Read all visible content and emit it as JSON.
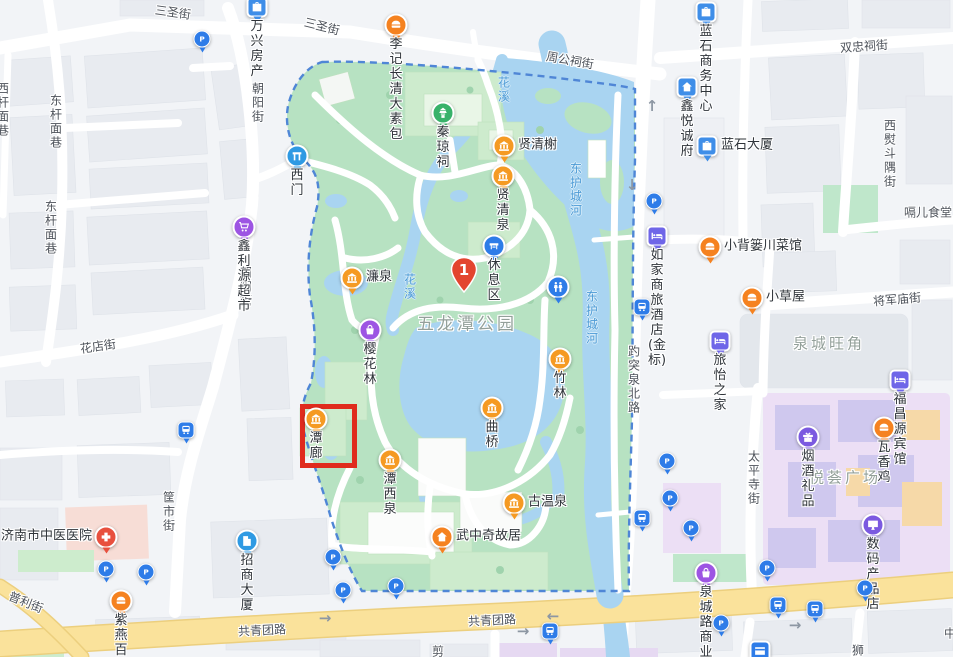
{
  "map": {
    "colors": {
      "park_green": "#b7e2c2",
      "park_building": "#cdebcd",
      "water": "#a9d4f1",
      "road_yellow": "#fae29b",
      "boundary_blue": "#4f86d6",
      "highlight_red": "#e02b1d",
      "marker_red": "#e3452f",
      "poi_orange": "#f59a23",
      "poi_food_orange": "#f58220",
      "poi_blue": "#2e7ce8",
      "poi_purple": "#9d55e3",
      "poi_hotel": "#6f66e8",
      "commercial_purple": "#ecdff5",
      "hospital_pink": "#f7ddd6"
    },
    "marker": {
      "number": "1",
      "x": 464,
      "y": 292
    },
    "highlight": {
      "x": 300,
      "y": 404,
      "w": 47,
      "h": 54
    },
    "area_labels": [
      {
        "text": "五龙潭公园",
        "x": 467,
        "y": 322,
        "size": 17
      },
      {
        "text": "泉城旺角",
        "x": 829,
        "y": 343,
        "size": 15
      },
      {
        "text": "悦荟广场",
        "x": 845,
        "y": 477,
        "size": 15
      }
    ],
    "street_labels": [
      {
        "text": "三圣街",
        "x": 173,
        "y": 12,
        "rot": 8
      },
      {
        "text": "三圣街",
        "x": 322,
        "y": 26,
        "rot": 14
      },
      {
        "text": "周公祠街",
        "x": 570,
        "y": 60,
        "rot": 10
      },
      {
        "text": "双忠祠街",
        "x": 864,
        "y": 46,
        "rot": -4
      },
      {
        "text": "西熨斗隅街",
        "x": 890,
        "y": 154,
        "vertical": true
      },
      {
        "text": "朝阳街",
        "x": 258,
        "y": 103,
        "vertical": true
      },
      {
        "text": "朝阳街",
        "x": 246,
        "y": 287,
        "vertical": true
      },
      {
        "text": "东杆面巷",
        "x": 56,
        "y": 122,
        "vertical": true
      },
      {
        "text": "东杆面巷",
        "x": 51,
        "y": 228,
        "vertical": true
      },
      {
        "text": "西杆面巷",
        "x": 3,
        "y": 110,
        "vertical": true
      },
      {
        "text": "花店街",
        "x": 98,
        "y": 346,
        "rot": -8
      },
      {
        "text": "筐市街",
        "x": 169,
        "y": 512,
        "vertical": true
      },
      {
        "text": "普利街",
        "x": 26,
        "y": 602,
        "rot": 22
      },
      {
        "text": "共青团路",
        "x": 262,
        "y": 630,
        "rot": -3
      },
      {
        "text": "共青团路",
        "x": 492,
        "y": 620,
        "rot": -3
      },
      {
        "text": "将军庙街",
        "x": 897,
        "y": 299,
        "rot": -5
      },
      {
        "text": "太平寺街",
        "x": 754,
        "y": 478,
        "vertical": true
      },
      {
        "text": "趵突泉北路",
        "x": 634,
        "y": 380,
        "vertical": true
      },
      {
        "text": "嗝儿食堂",
        "x": 928,
        "y": 212
      },
      {
        "text": "剪",
        "x": 438,
        "y": 651
      },
      {
        "text": "狮",
        "x": 858,
        "y": 650
      },
      {
        "text": "中",
        "x": 950,
        "y": 633
      }
    ],
    "water_labels": [
      {
        "text": "花溪",
        "x": 504,
        "y": 90,
        "vertical": true
      },
      {
        "text": "花溪",
        "x": 410,
        "y": 287,
        "vertical": true
      },
      {
        "text": "东护城河",
        "x": 576,
        "y": 190,
        "vertical": true
      },
      {
        "text": "东护城河",
        "x": 592,
        "y": 318,
        "vertical": true
      }
    ],
    "pois": [
      {
        "id": "wanxing-fangchan",
        "label": "万兴房产",
        "icon": "briefcase",
        "shape": "square",
        "color": "#3f8ee8",
        "x": 257,
        "y": 7,
        "label_pos": "below"
      },
      {
        "id": "liji-changqing-dasubao",
        "label": "李记长清大素包",
        "icon": "food",
        "shape": "circle",
        "color": "#f58220",
        "x": 396,
        "y": 25,
        "label_pos": "below"
      },
      {
        "id": "lanshi-business-center",
        "label": "蓝石商务中心",
        "icon": "briefcase",
        "shape": "square",
        "color": "#3f8ee8",
        "x": 706,
        "y": 12,
        "label_pos": "below"
      },
      {
        "id": "xinyue-chengfu",
        "label": "鑫悦诚府",
        "icon": "house",
        "shape": "square",
        "color": "#3f8ee8",
        "x": 687,
        "y": 87,
        "label_pos": "below"
      },
      {
        "id": "lanshi-daxia",
        "label": "蓝石大厦",
        "icon": "briefcase",
        "shape": "square",
        "color": "#3f8ee8",
        "x": 707,
        "y": 146,
        "label_pos": "right"
      },
      {
        "id": "ximen-west-gate",
        "label": "西门",
        "icon": "gate",
        "shape": "pinshape",
        "color": "#2f9ae3",
        "x": 297,
        "y": 156,
        "label_pos": "below"
      },
      {
        "id": "xinliyuan-chaoshi",
        "label": "鑫利源超市",
        "icon": "cart",
        "shape": "circle",
        "color": "#9d55e3",
        "x": 244,
        "y": 227,
        "label_pos": "below"
      },
      {
        "id": "qinqiong-ci",
        "label": "秦琼祠",
        "icon": "temple",
        "shape": "circle",
        "color": "#38b26a",
        "x": 443,
        "y": 113,
        "label_pos": "below"
      },
      {
        "id": "xianqing-xie",
        "label": "贤清榭",
        "icon": "museum",
        "shape": "circle",
        "color": "#f59a23",
        "x": 504,
        "y": 146,
        "label_pos": "right"
      },
      {
        "id": "xianqing-quan",
        "label": "贤清泉",
        "icon": "museum",
        "shape": "circle",
        "color": "#f59a23",
        "x": 503,
        "y": 176,
        "label_pos": "below"
      },
      {
        "id": "xiuxi-qu-rest-area",
        "label": "休息区",
        "icon": "bench",
        "shape": "circle",
        "color": "#2e7ce8",
        "x": 494,
        "y": 246,
        "label_pos": "below"
      },
      {
        "id": "restroom",
        "label": "",
        "icon": "wc",
        "shape": "circle",
        "color": "#2e7ce8",
        "x": 558,
        "y": 287,
        "label_pos": "none"
      },
      {
        "id": "lian-quan",
        "label": "濂泉",
        "icon": "museum",
        "shape": "circle",
        "color": "#f59a23",
        "x": 352,
        "y": 278,
        "label_pos": "right"
      },
      {
        "id": "yinghua-lin",
        "label": "樱花林",
        "icon": "bag",
        "shape": "circle",
        "color": "#9d55e3",
        "x": 370,
        "y": 330,
        "label_pos": "below"
      },
      {
        "id": "zhu-lin",
        "label": "竹林",
        "icon": "museum",
        "shape": "circle",
        "color": "#f59a23",
        "x": 560,
        "y": 359,
        "label_pos": "below"
      },
      {
        "id": "qu-qiao",
        "label": "曲桥",
        "icon": "museum",
        "shape": "circle",
        "color": "#f59a23",
        "x": 492,
        "y": 408,
        "label_pos": "below"
      },
      {
        "id": "tan-lang",
        "label": "潭廊",
        "icon": "museum",
        "shape": "circle",
        "color": "#f59a23",
        "x": 316,
        "y": 419,
        "label_pos": "below"
      },
      {
        "id": "tanxi-quan",
        "label": "潭西泉",
        "icon": "museum",
        "shape": "circle",
        "color": "#f59a23",
        "x": 390,
        "y": 460,
        "label_pos": "below"
      },
      {
        "id": "gu-wenquan",
        "label": "古温泉",
        "icon": "museum",
        "shape": "circle",
        "color": "#f59a23",
        "x": 514,
        "y": 503,
        "label_pos": "right"
      },
      {
        "id": "wuzhongqi-guju",
        "label": "武中奇故居",
        "icon": "house",
        "shape": "circle",
        "color": "#f58220",
        "x": 442,
        "y": 537,
        "label_pos": "right"
      },
      {
        "id": "rujia-hotel",
        "label": "如家商旅\n酒店(金标)",
        "icon": "bed",
        "shape": "square",
        "color": "#6f66e8",
        "x": 657,
        "y": 236,
        "label_pos": "below"
      },
      {
        "id": "xiaobeilou-chuancaiguan",
        "label": "小背篓川菜馆",
        "icon": "food",
        "shape": "circle",
        "color": "#f58220",
        "x": 710,
        "y": 247,
        "label_pos": "right"
      },
      {
        "id": "xiaocaowu",
        "label": "小草屋",
        "icon": "food",
        "shape": "circle",
        "color": "#f58220",
        "x": 752,
        "y": 298,
        "label_pos": "right"
      },
      {
        "id": "lvyi-zhijia",
        "label": "旅怡之家",
        "icon": "bed",
        "shape": "square",
        "color": "#6f66e8",
        "x": 720,
        "y": 341,
        "label_pos": "below"
      },
      {
        "id": "fuchangyuan-binguan",
        "label": "福昌源宾馆",
        "icon": "bed",
        "shape": "square",
        "color": "#6f66e8",
        "x": 900,
        "y": 380,
        "label_pos": "below"
      },
      {
        "id": "yanjiu-lipin",
        "label": "烟酒礼品",
        "icon": "gift",
        "shape": "circle",
        "color": "#7b5ae0",
        "x": 808,
        "y": 437,
        "label_pos": "below"
      },
      {
        "id": "waxiang-ji",
        "label": "瓦香鸡",
        "icon": "food",
        "shape": "circle",
        "color": "#f58220",
        "x": 884,
        "y": 428,
        "label_pos": "below"
      },
      {
        "id": "shuma-chanpin-dian",
        "label": "数码产品店",
        "icon": "monitor",
        "shape": "circle",
        "color": "#7b5ae0",
        "x": 873,
        "y": 525,
        "label_pos": "below"
      },
      {
        "id": "quanchenglu-shangyejie",
        "label": "泉城路商业街",
        "icon": "bag",
        "shape": "circle",
        "color": "#9d55e3",
        "x": 706,
        "y": 573,
        "label_pos": "below"
      },
      {
        "id": "jinan-zhongyi-hospital",
        "label": "济南市中医医院",
        "icon": "cross",
        "shape": "circle",
        "color": "#e8503e",
        "x": 106,
        "y": 537,
        "label_pos": "left"
      },
      {
        "id": "zhaoshang-daxia",
        "label": "招商大厦",
        "icon": "building",
        "shape": "circle",
        "color": "#2f9ae3",
        "x": 247,
        "y": 541,
        "label_pos": "below"
      },
      {
        "id": "ziyan-baiweiji",
        "label": "紫燕百味鸡",
        "icon": "food",
        "shape": "circle",
        "color": "#f58220",
        "x": 121,
        "y": 601,
        "label_pos": "below"
      },
      {
        "id": "bank-card-service",
        "label": "",
        "icon": "card",
        "shape": "square",
        "color": "#2e7ce8",
        "x": 760,
        "y": 651,
        "label_pos": "none"
      }
    ],
    "parking_icons": [
      [
        202,
        39
      ],
      [
        654,
        201
      ],
      [
        106,
        569
      ],
      [
        146,
        572
      ],
      [
        333,
        557
      ],
      [
        343,
        590
      ],
      [
        396,
        586
      ],
      [
        667,
        461
      ],
      [
        670,
        498
      ],
      [
        691,
        528
      ],
      [
        767,
        568
      ],
      [
        865,
        588
      ],
      [
        721,
        623
      ]
    ],
    "bus_stop_icons": [
      [
        186,
        430
      ],
      [
        642,
        307
      ],
      [
        642,
        518
      ],
      [
        550,
        631
      ],
      [
        778,
        605
      ],
      [
        815,
        609
      ]
    ],
    "arrows": [
      {
        "x": 652,
        "y": 106,
        "glyph": "↑"
      },
      {
        "x": 632,
        "y": 185,
        "glyph": "↓"
      },
      {
        "x": 553,
        "y": 616,
        "glyph": "←"
      },
      {
        "x": 523,
        "y": 631,
        "glyph": "→"
      },
      {
        "x": 325,
        "y": 618,
        "glyph": "→"
      },
      {
        "x": 795,
        "y": 625,
        "glyph": "→"
      }
    ]
  }
}
